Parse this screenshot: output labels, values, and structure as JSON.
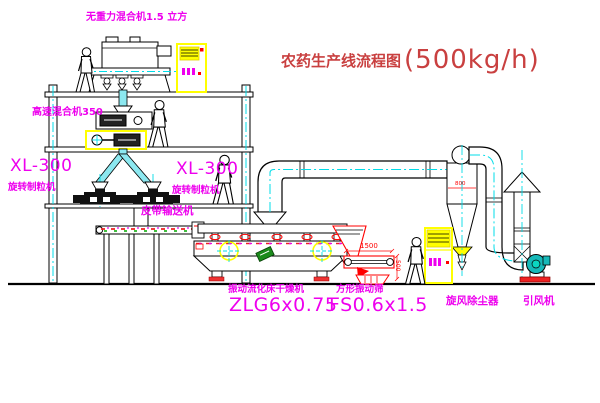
{
  "diagram": {
    "title": "农药生产线流程图",
    "capacity": "(500kg/h)"
  },
  "labels": {
    "gravity_mixer": "无重力混合机1.5 立方",
    "high_speed_mixer": "高速混合机350",
    "granulator_left": {
      "model": "XL-300",
      "name": "旋转制粒机"
    },
    "granulator_right": {
      "model": "XL-300",
      "name": "旋转制粒机"
    },
    "belt_conveyor": "皮带输送机",
    "dryer": {
      "name": "振动流化床干燥机",
      "model": "ZLG6x0.75"
    },
    "screen": {
      "name": "方形振动筛",
      "model": "FS0.6x1.5"
    },
    "cyclone": "旋风除尘器",
    "fan": "引风机"
  },
  "dimensions": {
    "screen_width": "1500",
    "screen_height": "500",
    "cyclone_dia": "800"
  },
  "colors": {
    "label_magenta": "#ee00ee",
    "title_red": "#c94040",
    "dimension_red": "#ff0000",
    "pipe_cyan": "#8ce8f0",
    "centerline_cyan": "#00dce8",
    "cabinet_yellow": "#ffff00",
    "line_black": "#000000",
    "fan_teal": "#16b8b8"
  }
}
